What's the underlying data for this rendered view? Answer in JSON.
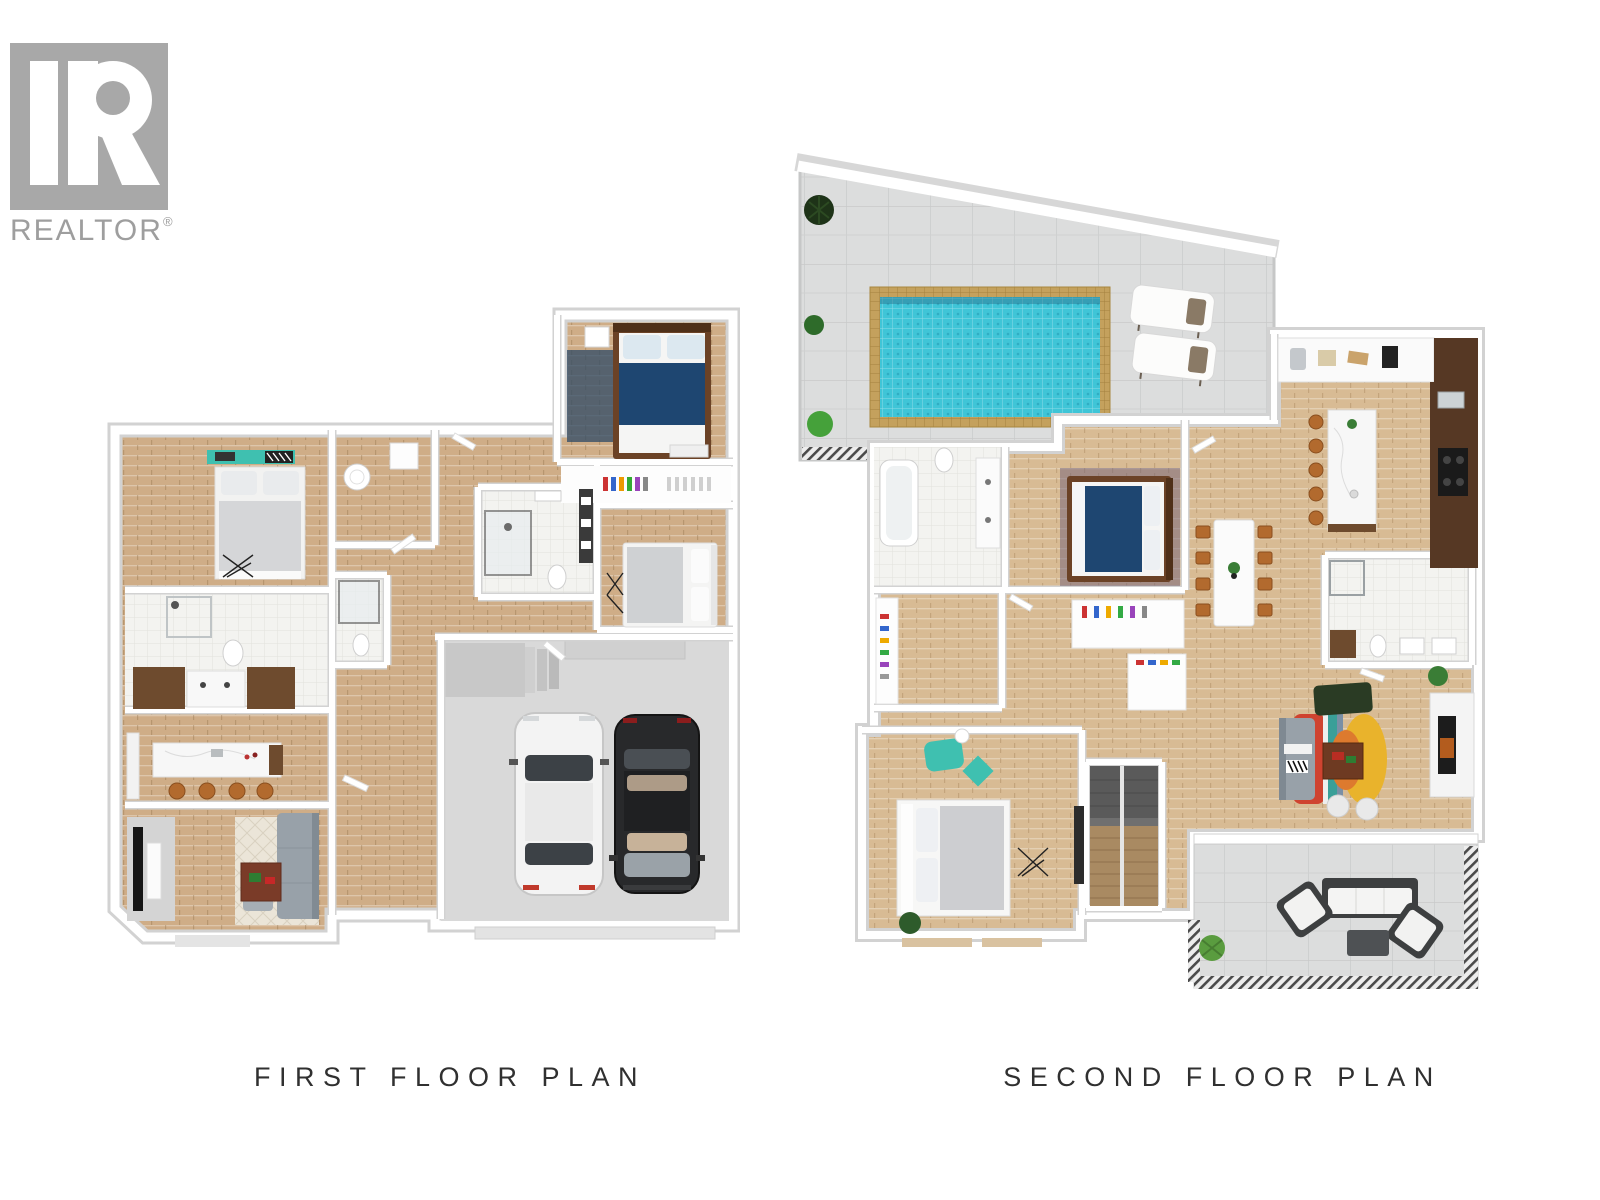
{
  "logo": {
    "brand_text": "REALTOR",
    "registered_symbol": "®"
  },
  "plans": [
    {
      "id": "first-floor",
      "label": "FIRST FLOOR PLAN"
    },
    {
      "id": "second-floor",
      "label": "SECOND FLOOR PLAN"
    }
  ],
  "palette": {
    "background": "#ffffff",
    "logo_gray": "#a8a8a8",
    "logo_text": "#9e9e9e",
    "label_text": "#303030",
    "wall": "#ffffff",
    "wall_edge": "#d2d2d2",
    "wood": "#cfad87",
    "wood_light": "#d8bb94",
    "tile": "#f3f3f0",
    "deck_tile": "#dcdddd",
    "pool_water": "#3fc5d7",
    "pool_edge": "#c4a15d",
    "garage_floor": "#d9d9d9",
    "bed_blue": "#1e4671",
    "bed_frame": "#6b4226",
    "cabinet_brown": "#6e4b2e",
    "cabinet_dark": "#563824",
    "stool_brown": "#b26a2e",
    "sofa_gray": "#98a1a9",
    "sofa_green": "#2a3b24",
    "rug_red": "#cf4330",
    "rug_yellow": "#e9b32c",
    "rug_orange": "#dd7a2e",
    "accent_teal": "#3fc0b0",
    "plant_green": "#3a7d36",
    "car_white": "#f3f3f3",
    "car_black": "#28292b",
    "stair_gray": "#6f6f6f",
    "railing_dark": "#4b4b4b"
  }
}
